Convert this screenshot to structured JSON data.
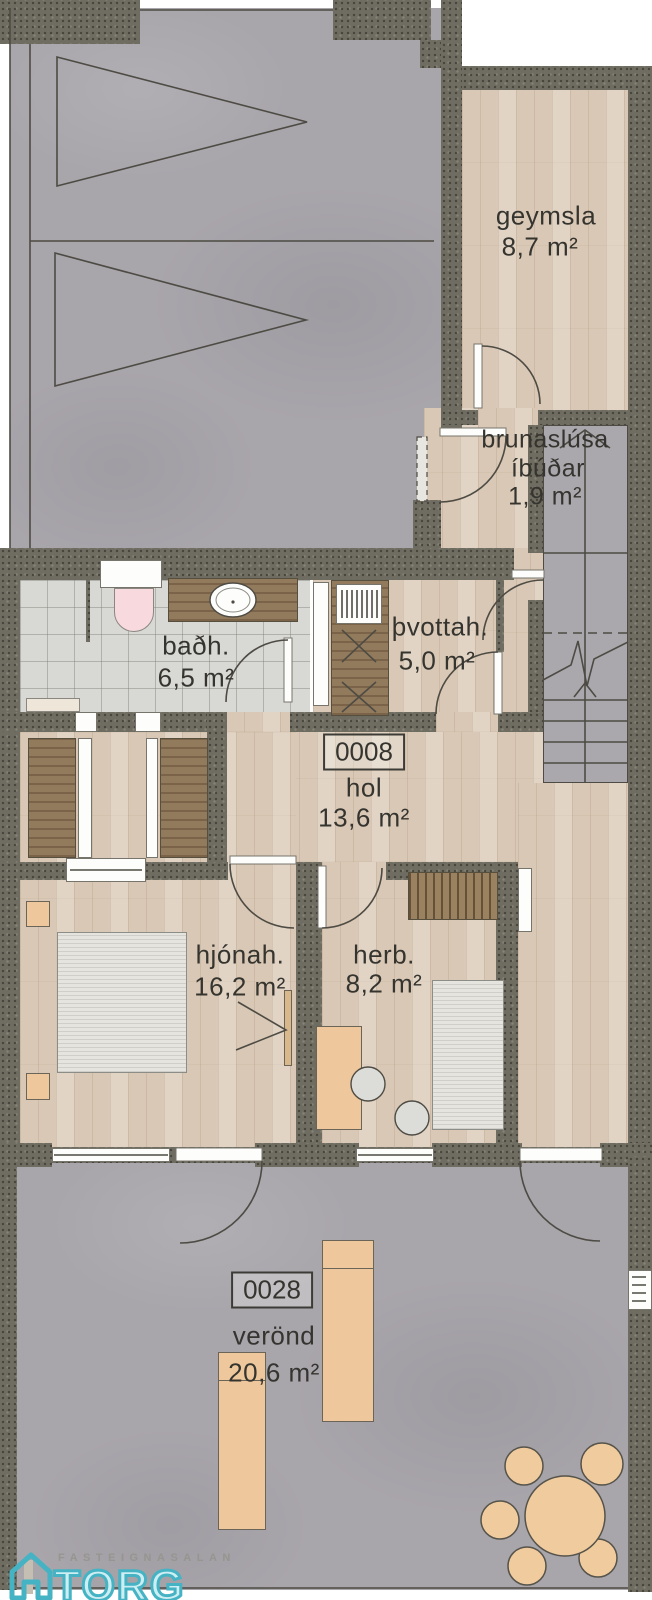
{
  "plan": {
    "rooms": [
      {
        "id": "geymsla",
        "label": "geymsla",
        "area": "8,7 m²"
      },
      {
        "id": "brunaslusa",
        "label": "brunaslúsa",
        "label2": "íbúðar",
        "area": "1,9 m²"
      },
      {
        "id": "thvottahus",
        "label": "þvottah.",
        "area": "5,0 m²"
      },
      {
        "id": "badherbergi",
        "label": "baðh.",
        "area": "6,5 m²"
      },
      {
        "id": "hol",
        "number": "0008",
        "label": "hol",
        "area": "13,6 m²"
      },
      {
        "id": "hjonaherbergi",
        "label": "hjónah.",
        "area": "16,2 m²"
      },
      {
        "id": "herbergi",
        "label": "herb.",
        "area": "8,2 m²"
      },
      {
        "id": "verond",
        "number": "0028",
        "label": "verönd",
        "area": "20,6 m²"
      }
    ]
  },
  "logo": {
    "top_text": "FASTEIGNASALAN",
    "name": "TORG"
  },
  "colors": {
    "wall": "#6f6d61",
    "wood_floor": "#d9c8b5",
    "concrete": "#a8a5ab",
    "tile": "#d8d8d5",
    "stairs": "#aaa8ad",
    "furniture_orange": "#eec89c",
    "toilet_pink": "#f7d9de",
    "logo_teal": "#45b3c3",
    "label_text": "#35342f"
  }
}
